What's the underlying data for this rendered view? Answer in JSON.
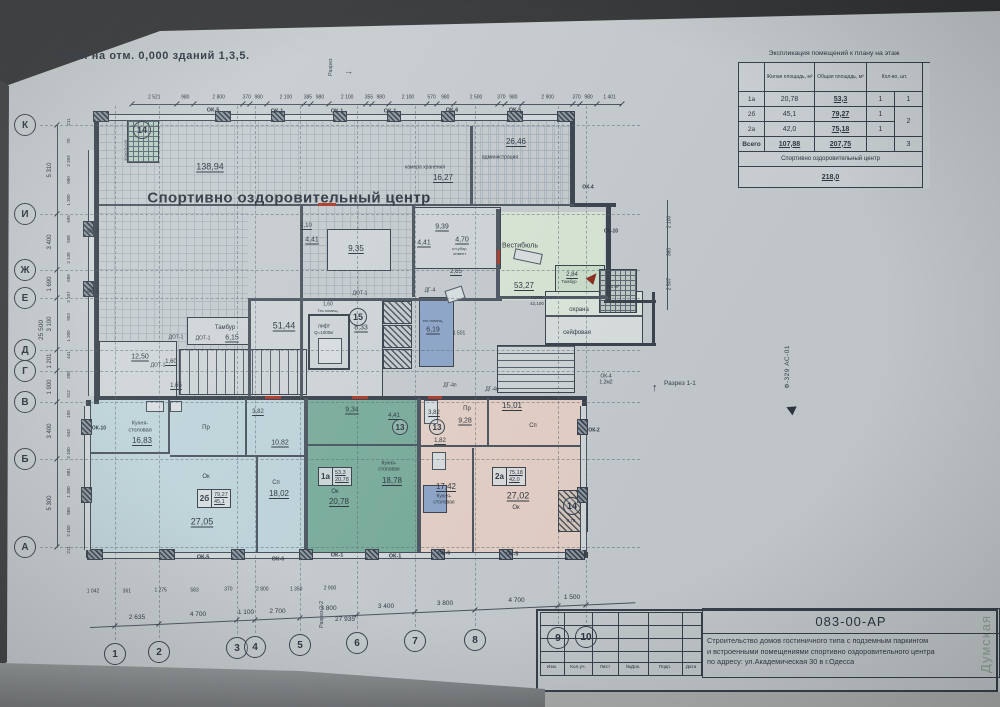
{
  "sheet": {
    "title": "План  на отм. 0,000  зданий 1,3,5.",
    "watermark": "Думская",
    "stamp": "Ф-329 АС-01"
  },
  "sections": {
    "top": "Разрез",
    "bottom": "Разрез 2-2",
    "right": "Разрез 1-1"
  },
  "explication": {
    "title": "Экспликация помещений к плану на этаж",
    "headers": {
      "living": "Жилая площадь, м²",
      "total": "Общая площадь, м²",
      "count": "Кол-во, шт."
    },
    "rows": [
      {
        "name": "1а",
        "living": "20,78",
        "total": "53,3",
        "count": "1",
        "group": "1"
      },
      {
        "name": "2б",
        "living": "45,1",
        "total": "79,27",
        "count": "1",
        "group": "2"
      },
      {
        "name": "2а",
        "living": "42,0",
        "total": "75,18",
        "count": "1",
        "group": ""
      },
      {
        "name": "Всего",
        "living": "107,88",
        "total": "207,75",
        "count": "",
        "group": "3"
      }
    ],
    "footer_label": "Спортивно оздоровительный центр",
    "footer_value": "218,0"
  },
  "titleblock": {
    "doc_number": "083-00-АР",
    "description": [
      "Строительство  домов гостиничного типа с подземным паркингом",
      "и встроенными помещениями спортивно оздоровительного центра",
      "по адресу:  ул.Академическая 30 в г.Одесса"
    ],
    "columns": [
      "Изм.",
      "Кол.уч.",
      "Лист",
      "№Док.",
      "Подп.",
      "Дата"
    ]
  },
  "axes": {
    "rows": [
      {
        "label": "К",
        "y": 125
      },
      {
        "label": "И",
        "y": 214
      },
      {
        "label": "Ж",
        "y": 270
      },
      {
        "label": "Е",
        "y": 298
      },
      {
        "label": "Д",
        "y": 350
      },
      {
        "label": "Г",
        "y": 371
      },
      {
        "label": "В",
        "y": 402
      },
      {
        "label": "Б",
        "y": 459
      },
      {
        "label": "А",
        "y": 547
      }
    ],
    "cols": [
      {
        "label": "1",
        "x": 115,
        "y": 654
      },
      {
        "label": "2",
        "x": 159,
        "y": 652
      },
      {
        "label": "3",
        "x": 237,
        "y": 648
      },
      {
        "label": "4",
        "x": 255,
        "y": 647
      },
      {
        "label": "5",
        "x": 300,
        "y": 645
      },
      {
        "label": "6",
        "x": 357,
        "y": 643
      },
      {
        "label": "7",
        "x": 415,
        "y": 641
      },
      {
        "label": "8",
        "x": 475,
        "y": 640
      },
      {
        "label": "9",
        "x": 558,
        "y": 638
      },
      {
        "label": "10",
        "x": 586,
        "y": 637
      }
    ],
    "row_dims": [
      "5 310",
      "3 400",
      "1 690",
      "3 100",
      "1 201",
      "1 900",
      "3 400",
      "5 300"
    ],
    "row_total": "25 500",
    "col_dims": [
      "2 635",
      "4 700",
      "1 100",
      "2 700",
      "3 800",
      "3 400",
      "3 800",
      "4 700",
      "1 500"
    ],
    "col_total": "27 935",
    "top_dims": [
      "2 521",
      "980",
      "2 800",
      "370",
      "980",
      "2 100",
      "385",
      "980",
      "2 100",
      "355",
      "980",
      "2 100",
      "570",
      "980",
      "2 500",
      "370",
      "980",
      "2 900",
      "370",
      "980",
      "1 401"
    ],
    "left_inner_dims": [
      "211",
      "70",
      "2 393",
      "980",
      "1 300",
      "495",
      "508",
      "2 138",
      "688",
      "2 107",
      "953",
      "1 200",
      "441",
      "200",
      "312",
      "105",
      "943",
      "2 100",
      "881",
      "1 300",
      "865",
      "2 450",
      "211"
    ],
    "bottom_inner_dims": [
      "1 042",
      "361",
      "1 275",
      "583",
      "370",
      "2 800",
      "1 350",
      "2 900"
    ],
    "right_dims": [
      "2 100",
      "360",
      "2 507"
    ]
  },
  "plan": {
    "hall_title": "Спортивно оздоровительный центр",
    "labels": [
      {
        "t": "138,94",
        "x": 210,
        "y": 167,
        "s": 9,
        "u": 1
      },
      {
        "t": "камера хранения",
        "x": 425,
        "y": 168,
        "s": 5
      },
      {
        "t": "16,27",
        "x": 443,
        "y": 178,
        "s": 8,
        "u": 1
      },
      {
        "t": "26,46",
        "x": 516,
        "y": 142,
        "s": 8,
        "u": 1
      },
      {
        "t": "администрация",
        "x": 500,
        "y": 158,
        "s": 5
      },
      {
        "t": "2,10",
        "x": 306,
        "y": 226,
        "s": 6,
        "u": 1
      },
      {
        "t": "4,41",
        "x": 312,
        "y": 240,
        "s": 7,
        "u": 1
      },
      {
        "t": "4,41",
        "x": 424,
        "y": 243,
        "s": 7,
        "u": 1
      },
      {
        "t": "9,35",
        "x": 356,
        "y": 249,
        "s": 8,
        "u": 1
      },
      {
        "t": "9,39",
        "x": 442,
        "y": 227,
        "s": 7,
        "u": 1
      },
      {
        "t": "4,70",
        "x": 462,
        "y": 240,
        "s": 7,
        "u": 1
      },
      {
        "t": "кл.убор.",
        "x": 460,
        "y": 249,
        "s": 4
      },
      {
        "t": "инвент.",
        "x": 460,
        "y": 254,
        "s": 4
      },
      {
        "t": "Вестибюль",
        "x": 520,
        "y": 246,
        "s": 7
      },
      {
        "t": "53,27",
        "x": 524,
        "y": 286,
        "s": 8,
        "u": 1
      },
      {
        "t": "2,84",
        "x": 572,
        "y": 275,
        "s": 6,
        "u": 1
      },
      {
        "t": "Тамбур",
        "x": 569,
        "y": 282,
        "s": 4.5
      },
      {
        "t": "6,1 м²",
        "x": 613,
        "y": 287,
        "s": 4.5
      },
      {
        "t": "охрана",
        "x": 579,
        "y": 310,
        "s": 6
      },
      {
        "t": "сейфовая",
        "x": 577,
        "y": 333,
        "s": 6
      },
      {
        "t": "0,000",
        "x": 537,
        "y": 298,
        "s": 4.5
      },
      {
        "t": "42,100",
        "x": 537,
        "y": 304,
        "s": 4.5
      },
      {
        "t": "2,65",
        "x": 456,
        "y": 272,
        "s": 6,
        "u": 1
      },
      {
        "t": "Тамбур",
        "x": 225,
        "y": 328,
        "s": 6
      },
      {
        "t": "6,15",
        "x": 232,
        "y": 338,
        "s": 7,
        "u": 1
      },
      {
        "t": "51,44",
        "x": 284,
        "y": 326,
        "s": 9,
        "u": 1
      },
      {
        "t": "ДОТ-1",
        "x": 176,
        "y": 338,
        "s": 5
      },
      {
        "t": "ДОТ-1",
        "x": 203,
        "y": 339,
        "s": 5
      },
      {
        "t": "12,50",
        "x": 140,
        "y": 357,
        "s": 7,
        "u": 1
      },
      {
        "t": "1,60",
        "x": 171,
        "y": 362,
        "s": 6,
        "u": 1
      },
      {
        "t": "ДОТ-1",
        "x": 158,
        "y": 366,
        "s": 5
      },
      {
        "t": "1,65",
        "x": 176,
        "y": 386,
        "s": 6,
        "u": 1
      },
      {
        "t": "лифт",
        "x": 324,
        "y": 327,
        "s": 5
      },
      {
        "t": "Q=1000кг",
        "x": 324,
        "y": 333,
        "s": 4.5
      },
      {
        "t": "8,33",
        "x": 361,
        "y": 328,
        "s": 7,
        "u": 1
      },
      {
        "t": "1,60",
        "x": 328,
        "y": 305,
        "s": 5
      },
      {
        "t": "Тех.помещ.",
        "x": 328,
        "y": 311,
        "s": 4
      },
      {
        "t": "тех.помещ.",
        "x": 433,
        "y": 321,
        "s": 4
      },
      {
        "t": "6,19",
        "x": 433,
        "y": 330,
        "s": 7,
        "u": 1
      },
      {
        "t": "1 501",
        "x": 459,
        "y": 334,
        "s": 5
      },
      {
        "t": "ДГ-4",
        "x": 430,
        "y": 291,
        "s": 5
      },
      {
        "t": "ДГ-4п",
        "x": 450,
        "y": 386,
        "s": 5
      },
      {
        "t": "ДГ-4н",
        "x": 492,
        "y": 390,
        "s": 5
      },
      {
        "t": "ДОТ-1",
        "x": 360,
        "y": 294,
        "s": 5
      },
      {
        "t": "ОК-4",
        "x": 606,
        "y": 377,
        "s": 5
      },
      {
        "t": "1,2м2",
        "x": 606,
        "y": 383,
        "s": 5
      },
      {
        "t": "Кухня-",
        "x": 140,
        "y": 424,
        "s": 5.5
      },
      {
        "t": "столовая",
        "x": 140,
        "y": 431,
        "s": 5.5
      },
      {
        "t": "16,83",
        "x": 142,
        "y": 441,
        "s": 8,
        "u": 1
      },
      {
        "t": "3,82",
        "x": 258,
        "y": 412,
        "s": 6,
        "u": 1
      },
      {
        "t": "Пр",
        "x": 206,
        "y": 428,
        "s": 6
      },
      {
        "t": "10,82",
        "x": 280,
        "y": 443,
        "s": 7,
        "u": 1
      },
      {
        "t": "Ок",
        "x": 206,
        "y": 477,
        "s": 6
      },
      {
        "t": "27,05",
        "x": 202,
        "y": 522,
        "s": 9,
        "u": 1
      },
      {
        "t": "Сп",
        "x": 276,
        "y": 483,
        "s": 6
      },
      {
        "t": "18,02",
        "x": 279,
        "y": 494,
        "s": 8,
        "u": 1
      },
      {
        "t": "9,34",
        "x": 352,
        "y": 410,
        "s": 7,
        "u": 1
      },
      {
        "t": "4,41",
        "x": 394,
        "y": 416,
        "s": 6,
        "u": 1
      },
      {
        "t": "3,82",
        "x": 434,
        "y": 413,
        "s": 6,
        "u": 1
      },
      {
        "t": "1,82",
        "x": 440,
        "y": 441,
        "s": 6,
        "u": 1
      },
      {
        "t": "Кухня-",
        "x": 389,
        "y": 464,
        "s": 5
      },
      {
        "t": "столовая",
        "x": 389,
        "y": 470,
        "s": 5
      },
      {
        "t": "18,78",
        "x": 392,
        "y": 481,
        "s": 8,
        "u": 1
      },
      {
        "t": "Ок",
        "x": 335,
        "y": 492,
        "s": 6
      },
      {
        "t": "20,78",
        "x": 339,
        "y": 502,
        "s": 8,
        "u": 1
      },
      {
        "t": "Пр",
        "x": 467,
        "y": 409,
        "s": 6
      },
      {
        "t": "9,28",
        "x": 465,
        "y": 421,
        "s": 7,
        "u": 1
      },
      {
        "t": "15,01",
        "x": 512,
        "y": 406,
        "s": 8,
        "u": 1
      },
      {
        "t": "Сп",
        "x": 533,
        "y": 426,
        "s": 6
      },
      {
        "t": "17,42",
        "x": 446,
        "y": 487,
        "s": 8,
        "u": 1
      },
      {
        "t": "Кухня-",
        "x": 444,
        "y": 497,
        "s": 5
      },
      {
        "t": "столовая",
        "x": 444,
        "y": 503,
        "s": 5
      },
      {
        "t": "27,02",
        "x": 518,
        "y": 496,
        "s": 9,
        "u": 1
      },
      {
        "t": "Ок",
        "x": 516,
        "y": 508,
        "s": 6
      },
      {
        "t": "0,76",
        "x": 571,
        "y": 521,
        "s": 4.5
      },
      {
        "t": "3,0х0,3=0,9",
        "x": 124,
        "y": 140,
        "s": 4,
        "v": 1
      },
      {
        "t": "ОК-5",
        "x": 213,
        "y": 111,
        "s": 5.5,
        "b": 1
      },
      {
        "t": "ОК-1",
        "x": 277,
        "y": 112,
        "s": 5.5,
        "b": 1
      },
      {
        "t": "ОК-1",
        "x": 337,
        "y": 112,
        "s": 5.5,
        "b": 1
      },
      {
        "t": "ОК-1",
        "x": 390,
        "y": 112,
        "s": 5.5,
        "b": 1
      },
      {
        "t": "ОК-6",
        "x": 452,
        "y": 111,
        "s": 5.5,
        "b": 1
      },
      {
        "t": "ОК-5",
        "x": 515,
        "y": 111,
        "s": 5.5,
        "b": 1
      },
      {
        "t": "ОК-5",
        "x": 203,
        "y": 558,
        "s": 5.5,
        "b": 1
      },
      {
        "t": "ОК-6",
        "x": 278,
        "y": 560,
        "s": 5.5,
        "b": 1
      },
      {
        "t": "ОК-1",
        "x": 337,
        "y": 556,
        "s": 5.5,
        "b": 1
      },
      {
        "t": "ОК-1",
        "x": 395,
        "y": 557,
        "s": 5.5,
        "b": 1
      },
      {
        "t": "ОК-6",
        "x": 444,
        "y": 554,
        "s": 5.5,
        "b": 1
      },
      {
        "t": "ОК-5",
        "x": 512,
        "y": 555,
        "s": 5.5,
        "b": 1
      },
      {
        "t": "ОК-1",
        "x": 93,
        "y": 232,
        "s": 5,
        "b": 1
      },
      {
        "t": "ОК-1",
        "x": 93,
        "y": 292,
        "s": 5,
        "b": 1
      },
      {
        "t": "ОК-10",
        "x": 99,
        "y": 429,
        "s": 5,
        "b": 1
      },
      {
        "t": "ОК-4",
        "x": 588,
        "y": 188,
        "s": 5,
        "b": 1
      },
      {
        "t": "ОК-10",
        "x": 611,
        "y": 232,
        "s": 5,
        "b": 1
      },
      {
        "t": "ОК-2",
        "x": 594,
        "y": 431,
        "s": 5,
        "b": 1
      }
    ],
    "tags": [
      {
        "n": "2б",
        "top": "79,27",
        "bot": "45,1",
        "x": 197,
        "y": 489
      },
      {
        "n": "1а",
        "top": "53,3",
        "bot": "20,78",
        "x": 318,
        "y": 467
      },
      {
        "n": "2а",
        "top": "75,18",
        "bot": "42,0",
        "x": 492,
        "y": 467
      }
    ],
    "circles": [
      {
        "n": "15",
        "x": 358,
        "y": 317,
        "r": 9
      },
      {
        "n": "13",
        "x": 400,
        "y": 427,
        "r": 8
      },
      {
        "n": "13",
        "x": 437,
        "y": 427,
        "r": 8
      },
      {
        "n": "14",
        "x": 142,
        "y": 130,
        "r": 9
      },
      {
        "n": "14",
        "x": 572,
        "y": 506,
        "r": 9
      }
    ]
  }
}
